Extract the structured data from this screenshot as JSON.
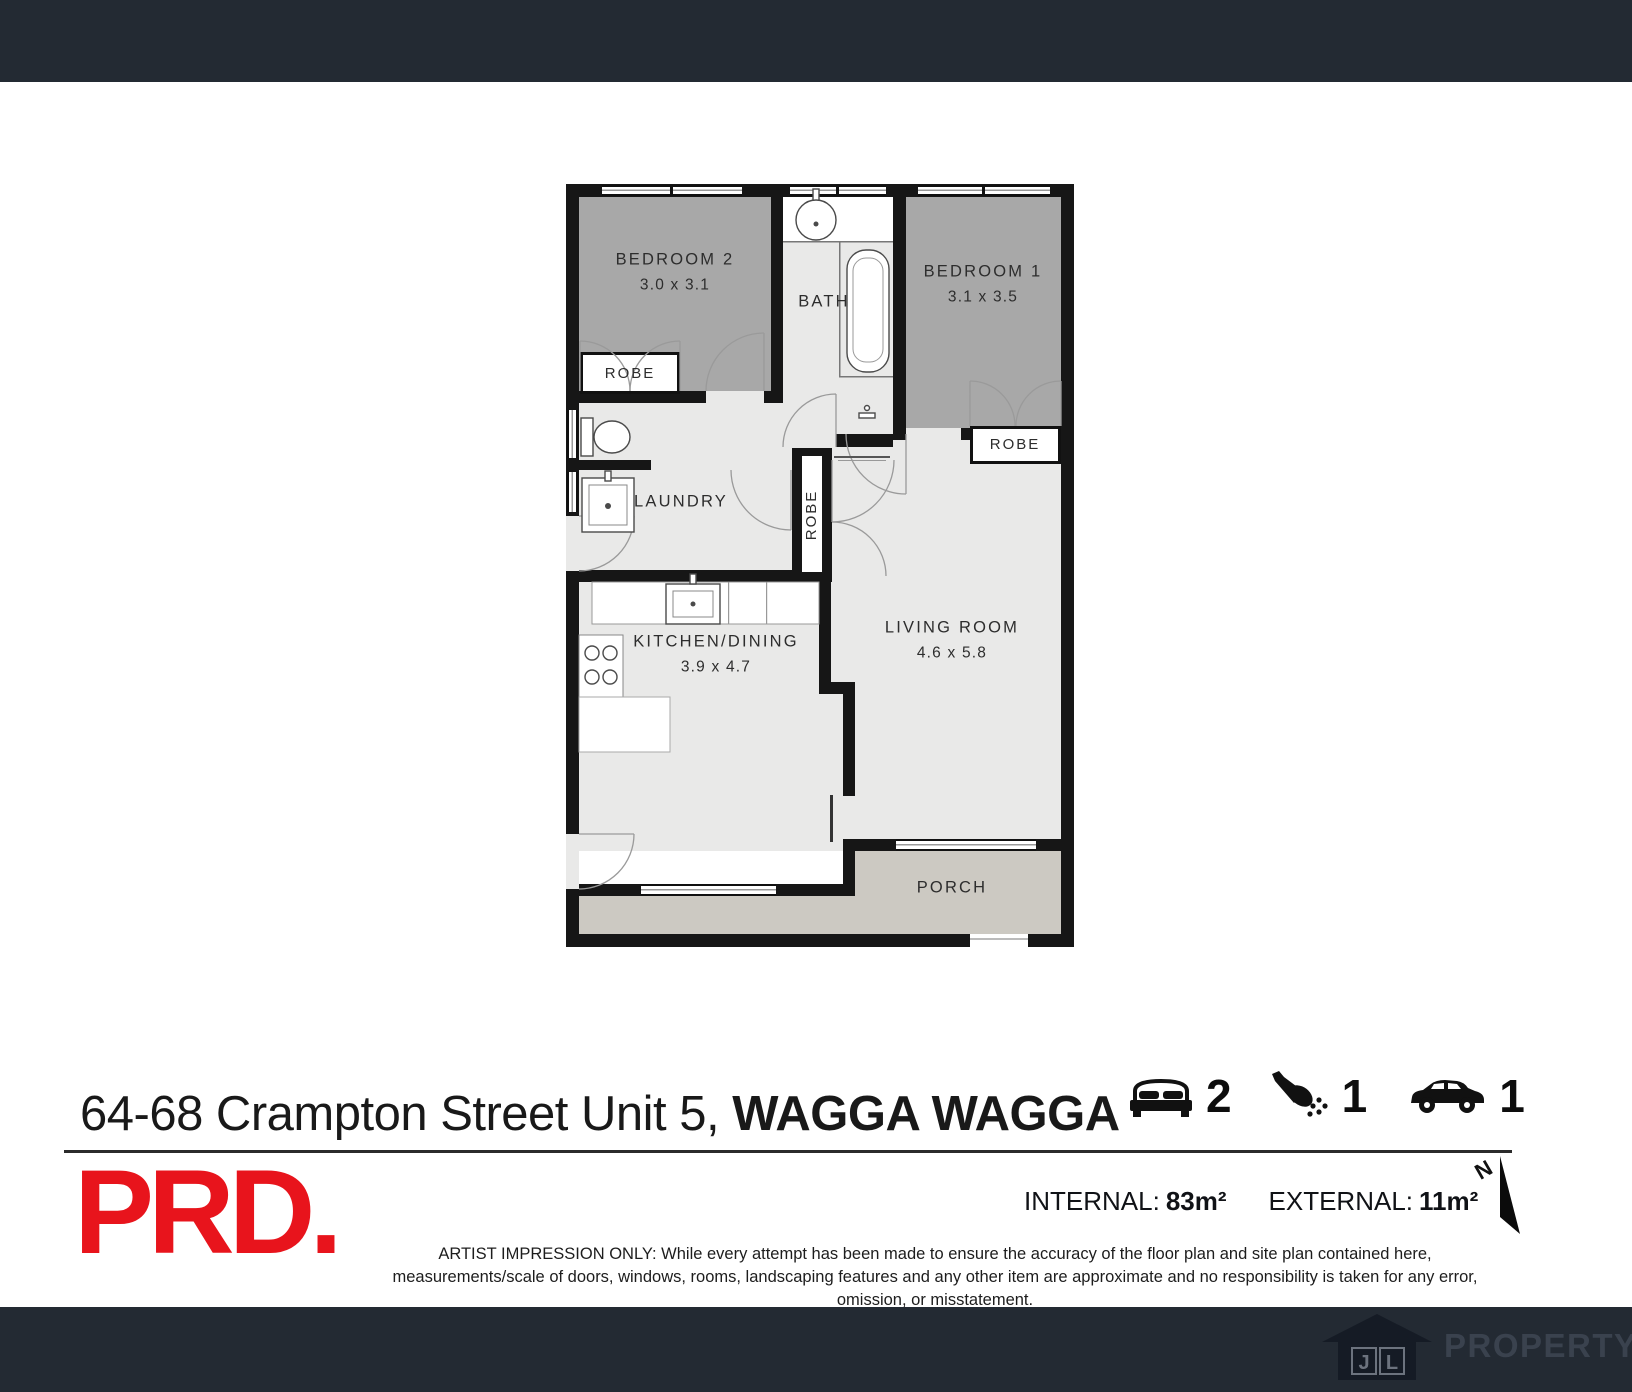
{
  "floorplan": {
    "rooms": {
      "bedroom2": {
        "name": "BEDROOM 2",
        "dims": "3.0 x 3.1"
      },
      "bedroom1": {
        "name": "BEDROOM 1",
        "dims": "3.1 x 3.5"
      },
      "bath": {
        "name": "BATH"
      },
      "laundry": {
        "name": "LAUNDRY"
      },
      "kitchen_dining": {
        "name": "KITCHEN/DINING",
        "dims": "3.9 x 4.7"
      },
      "living_room": {
        "name": "LIVING ROOM",
        "dims": "4.6 x 5.8"
      },
      "porch": {
        "name": "PORCH"
      },
      "robe_bedroom2": {
        "name": "ROBE"
      },
      "robe_bedroom1": {
        "name": "ROBE"
      },
      "robe_hall": {
        "name": "ROBE"
      }
    }
  },
  "listing": {
    "address_street": "64-68 Crampton Street Unit 5,",
    "address_locality": "WAGGA WAGGA",
    "bedrooms": "2",
    "bathrooms": "1",
    "car_spaces": "1"
  },
  "areas": {
    "internal_label": "INTERNAL:",
    "internal_value": "83m²",
    "external_label": "EXTERNAL:",
    "external_value": "11m²"
  },
  "compass": {
    "north": "N"
  },
  "branding": {
    "agency_logo": "PRD.",
    "footer_initial_1": "J",
    "footer_initial_2": "L",
    "footer_name": "PROPERTY"
  },
  "disclaimer": "ARTIST IMPRESSION ONLY: While every attempt has been made to ensure the accuracy of the floor plan and site plan contained here, measurements/scale of doors, windows, rooms, landscaping features and any other item are approximate and no responsibility is taken for any error, omission, or misstatement.",
  "colors": {
    "bar": "#232a33",
    "bedroom_fill": "#a8a8a8",
    "floor_fill": "#e9e9e8",
    "porch_fill": "#ccc9c2",
    "wall": "#161616",
    "brand_red": "#e8141c"
  }
}
